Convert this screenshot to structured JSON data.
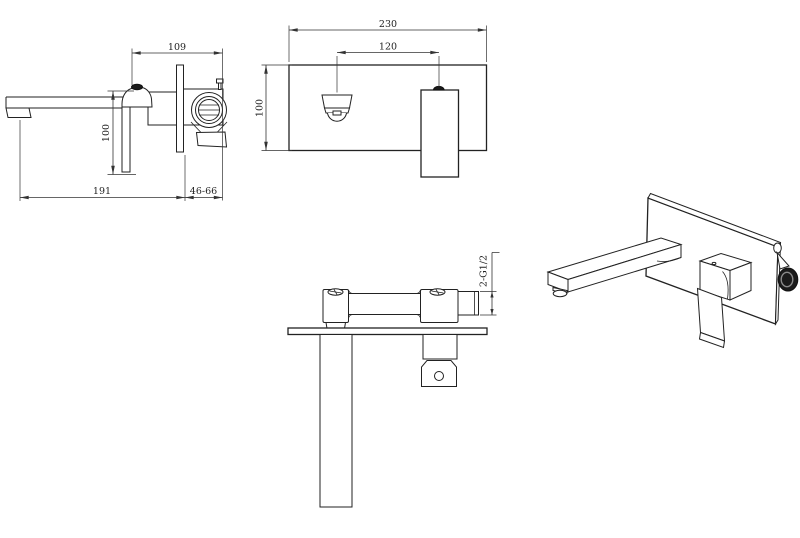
{
  "colors": {
    "background": "#ffffff",
    "line": "#222222",
    "dimension_line": "#333333",
    "text": "#222222",
    "dark_fitting": "#1b1b1b"
  },
  "views": {
    "side": {
      "dims": {
        "body_depth": "109",
        "overall_height": "100",
        "spout_reach": "191",
        "wall_adjustment": "46-66"
      }
    },
    "front": {
      "dims": {
        "plate_width": "230",
        "spout_handle_spacing": "120",
        "plate_height": "100"
      }
    },
    "top": {
      "dims": {
        "inlet_thread": "2-G1/2"
      }
    }
  }
}
